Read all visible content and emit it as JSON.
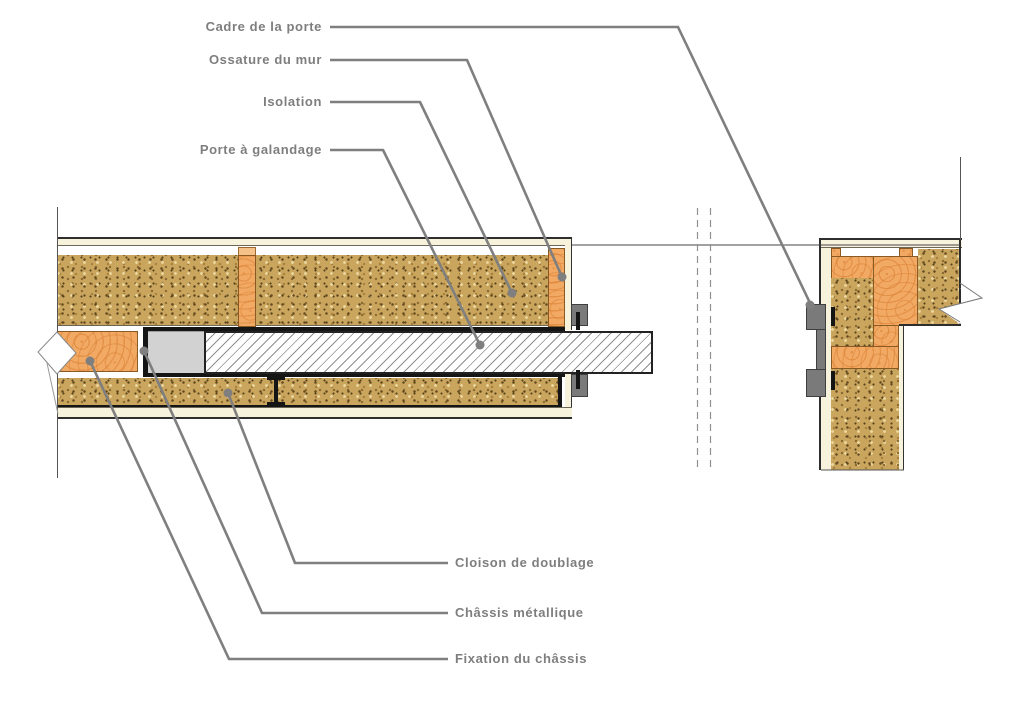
{
  "diagram": {
    "kind": "architectural-section-pocket-door",
    "callouts_top": [
      {
        "id": "cadre",
        "label": "Cadre de la porte"
      },
      {
        "id": "ossature",
        "label": "Ossature du mur"
      },
      {
        "id": "isolation",
        "label": "Isolation"
      },
      {
        "id": "porte",
        "label": "Porte à galandage"
      }
    ],
    "callouts_bottom": [
      {
        "id": "cloison",
        "label": "Cloison de doublage"
      },
      {
        "id": "chassis",
        "label": "Châssis métallique"
      },
      {
        "id": "fixation",
        "label": "Fixation du châssis"
      }
    ],
    "colors": {
      "label_text": "#7e7e7e",
      "leader_line": "#7f7f7f",
      "insulation": "#c9a55e",
      "wood": "#f1a963",
      "plasterboard": "#f7f2db",
      "metal_frame_fill": "#d2d2d2",
      "bracket_gray": "#7a7a7a",
      "outline": "#222222",
      "hatch_line": "#8f8f8f"
    }
  }
}
